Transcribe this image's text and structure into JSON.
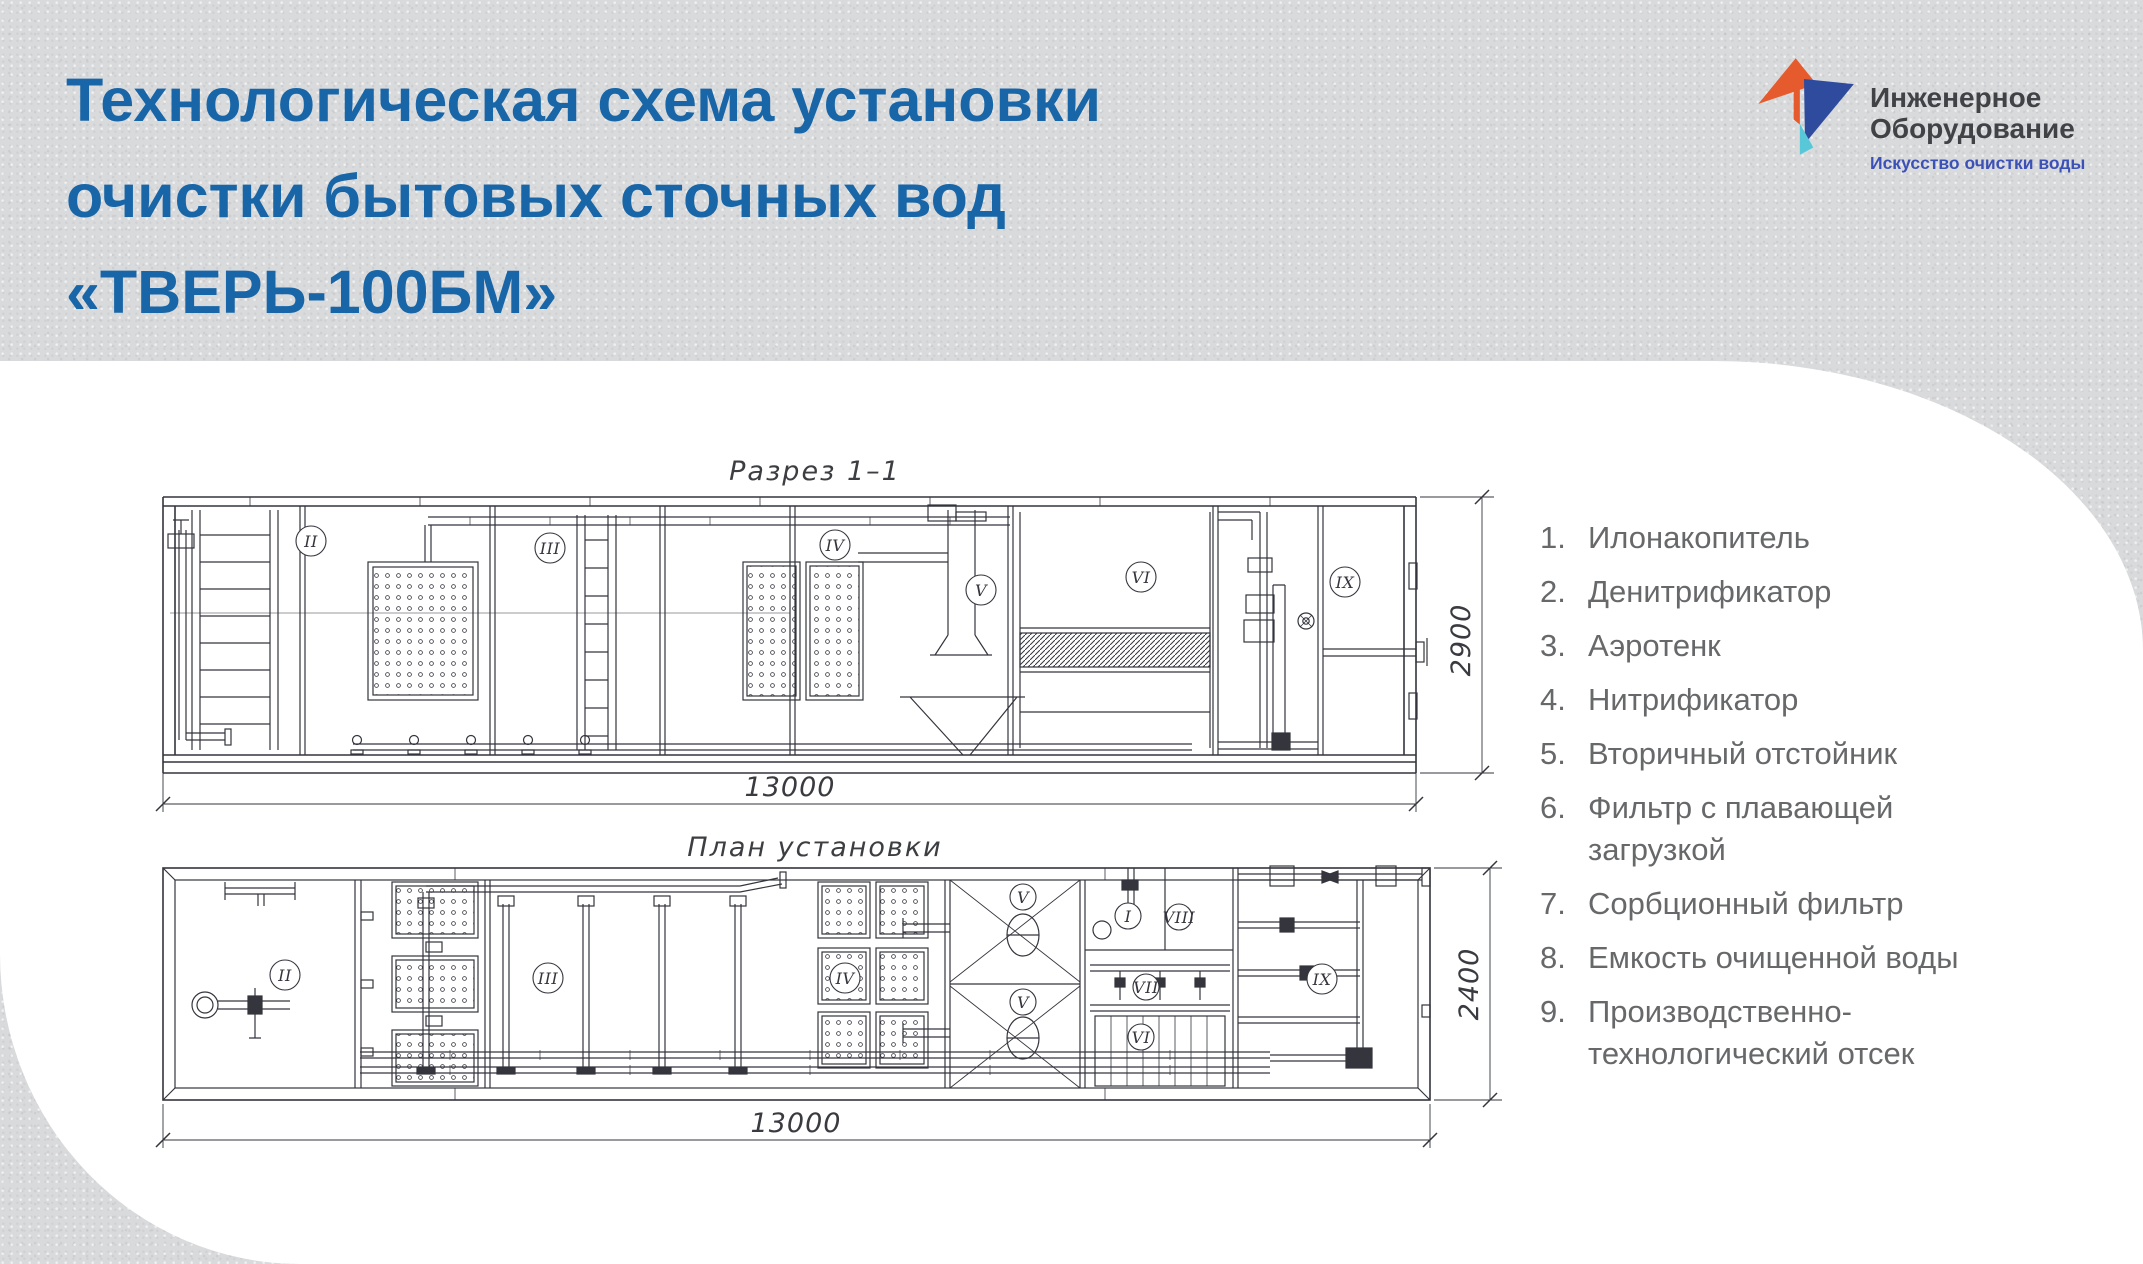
{
  "title": {
    "line1": "Технологическая схема установки",
    "line2": "очистки бытовых сточных вод",
    "line3": "«ТВЕРЬ-100БМ»"
  },
  "logo": {
    "line1": "Инженерное",
    "line2": "Оборудование",
    "tagline": "Искусство очистки воды"
  },
  "colors": {
    "title_blue": "#1866a7",
    "logo_orange": "#e55b2d",
    "logo_blue": "#2f4b9e",
    "logo_teal": "#58c8d8",
    "tagline_blue": "#3c51b7"
  },
  "cross_section": {
    "caption": "Разрез 1–1",
    "length_dim": "13000",
    "height_dim": "2900",
    "labels": [
      "II",
      "III",
      "IV",
      "V",
      "VI",
      "IX"
    ]
  },
  "plan": {
    "caption": "План установки",
    "length_dim": "13000",
    "width_dim": "2400",
    "labels": [
      "II",
      "III",
      "IV",
      "V",
      "V",
      "I",
      "VIII",
      "VII",
      "VI",
      "IX"
    ]
  },
  "legend": {
    "items": [
      {
        "num": "1.",
        "text": "Илонакопитель"
      },
      {
        "num": "2.",
        "text": "Денитрификатор"
      },
      {
        "num": "3.",
        "text": "Аэротенк"
      },
      {
        "num": "4.",
        "text": "Нитрификатор"
      },
      {
        "num": "5.",
        "text": "Вторичный отстойник"
      },
      {
        "num": "6.",
        "text": "Фильтр с плавающей загрузкой"
      },
      {
        "num": "7.",
        "text": "Сорбционный фильтр"
      },
      {
        "num": "8.",
        "text": "Емкость очищенной воды"
      },
      {
        "num": "9.",
        "text": "Производственно-технологический отсек"
      }
    ]
  }
}
